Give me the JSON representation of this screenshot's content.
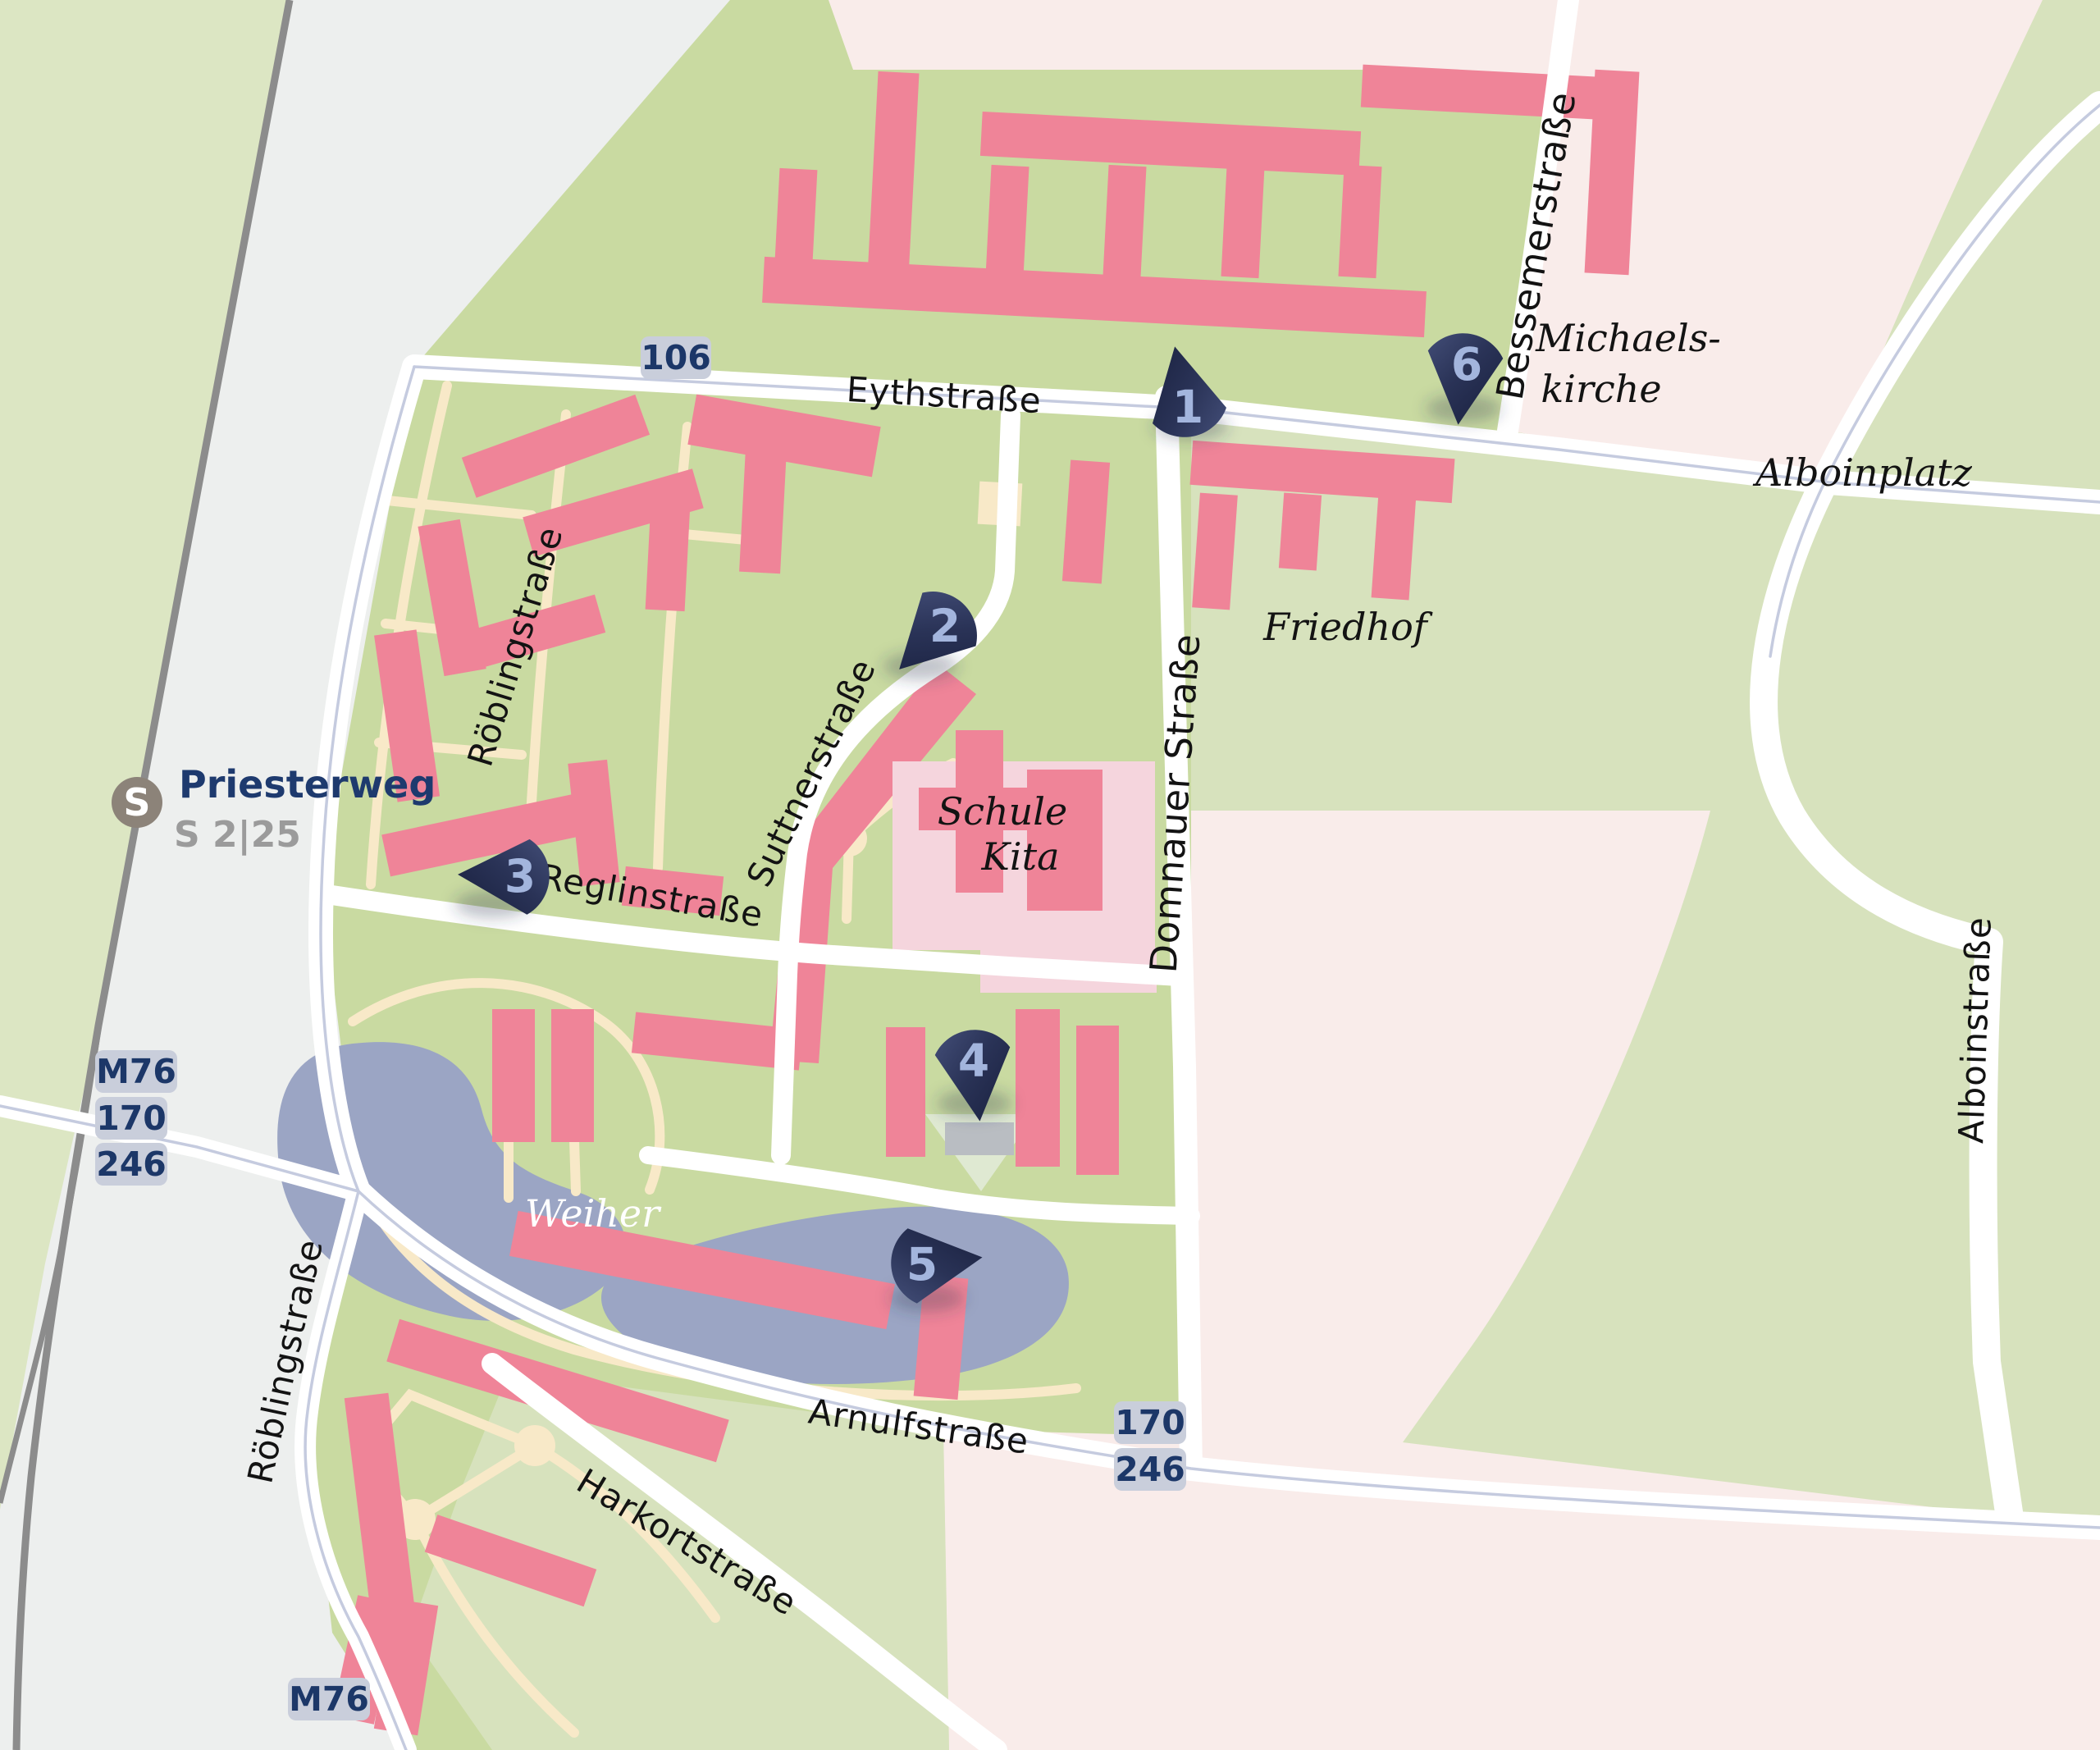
{
  "map": {
    "station": {
      "logo": "S",
      "name": "Priesterweg",
      "lines": "S 2|25"
    },
    "street_labels": [
      {
        "text": "Eythstraße"
      },
      {
        "text": "Röblingstraße"
      },
      {
        "text": "Röblingstraße"
      },
      {
        "text": "Suttnerstraße"
      },
      {
        "text": "Reglinstraße"
      },
      {
        "text": "Domnauer Straße"
      },
      {
        "text": "Bessemerstraße"
      },
      {
        "text": "Arnulfstraße"
      },
      {
        "text": "Harkortstraße"
      },
      {
        "text": "Alboinstraße"
      }
    ],
    "place_labels": [
      {
        "text": "Michaels-"
      },
      {
        "text": "kirche"
      },
      {
        "text": "Alboinplatz"
      },
      {
        "text": "Friedhof"
      },
      {
        "text": "Schule"
      },
      {
        "text": "Kita"
      },
      {
        "text": "Weiher"
      }
    ],
    "bus_badges": [
      {
        "text": "106"
      },
      {
        "text": "M76"
      },
      {
        "text": "170"
      },
      {
        "text": "246"
      },
      {
        "text": "170"
      },
      {
        "text": "246"
      },
      {
        "text": "M76"
      }
    ],
    "markers": [
      {
        "label": "1"
      },
      {
        "label": "2"
      },
      {
        "label": "3"
      },
      {
        "label": "4"
      },
      {
        "label": "5"
      },
      {
        "label": "6"
      }
    ]
  },
  "colors": {
    "green-base": "#c9daa1",
    "green-left": "#dce6c3",
    "green-light": "#d7e2bd",
    "gray-area": "#edefee",
    "pink-area": "#f9ecea",
    "building": "#ef8498",
    "school": "#f5d5dd",
    "pond": "#9ba5c4",
    "path": "#f8e9c8",
    "road": "#ffffff",
    "road-line": "#c5cbdf",
    "rail": "#8c8c8c",
    "badge-bg": "#c9cedb",
    "navy": "#1c3768",
    "marker-dark": "#1f2747",
    "marker-light": "#39446c",
    "number": "#a3b5dd",
    "sbahn": "#8c8379",
    "label": "#131313",
    "gray-text": "#9b9b9b"
  }
}
